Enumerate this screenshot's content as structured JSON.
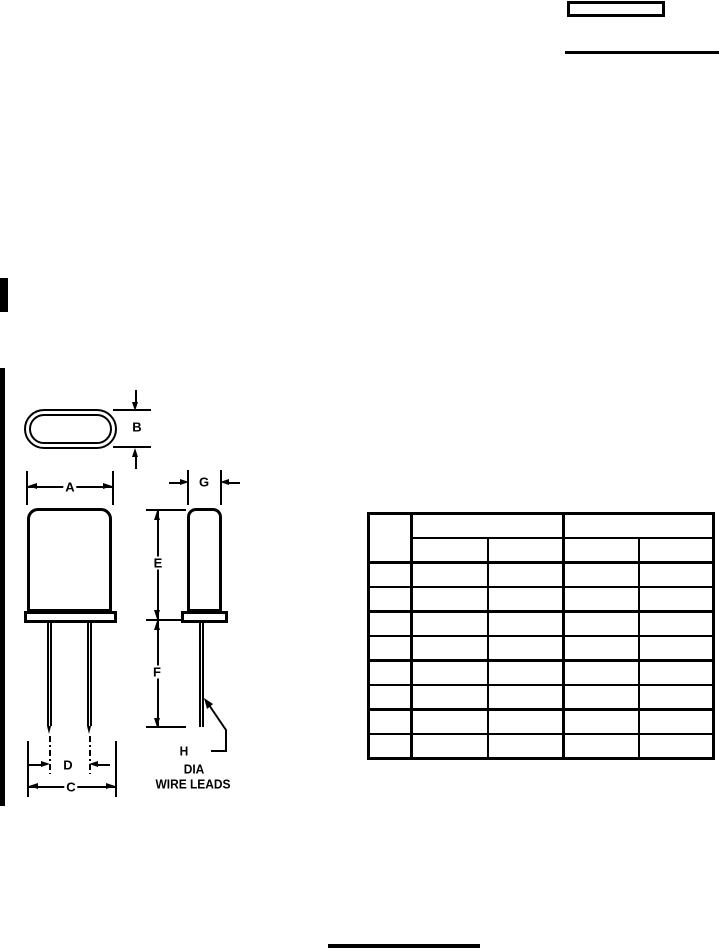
{
  "document": {
    "kind": "component mechanical drawing page",
    "paper_color": "#ffffff",
    "ink_color": "#000000"
  },
  "drawing": {
    "dimension_labels": {
      "a": "A",
      "b": "B",
      "c": "C",
      "d": "D",
      "e": "E",
      "f": "F",
      "g": "G"
    },
    "lead_callout": {
      "h": "H",
      "dia": "DIA",
      "wire_leads": "WIRE LEADS"
    }
  },
  "table": {
    "header": {
      "corner": "",
      "group_left": "",
      "group_right": "",
      "subcolumns": [
        "",
        "",
        "",
        ""
      ]
    },
    "rows": [
      [
        "",
        "",
        "",
        "",
        ""
      ],
      [
        "",
        "",
        "",
        "",
        ""
      ],
      [
        "",
        "",
        "",
        "",
        ""
      ],
      [
        "",
        "",
        "",
        "",
        ""
      ],
      [
        "",
        "",
        "",
        "",
        ""
      ],
      [
        "",
        "",
        "",
        "",
        ""
      ],
      [
        "",
        "",
        "",
        "",
        ""
      ],
      [
        "",
        "",
        "",
        "",
        ""
      ]
    ]
  }
}
